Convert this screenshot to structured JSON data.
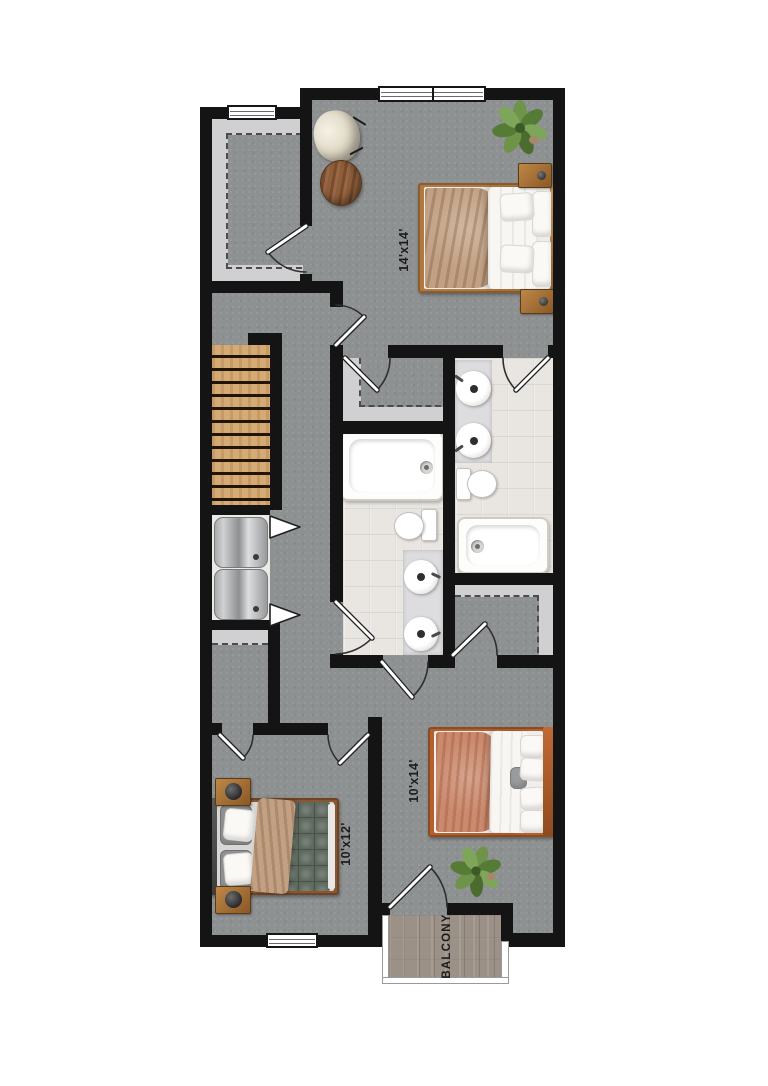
{
  "plan": {
    "rooms": {
      "master_bedroom": {
        "dimension_label": "14'x14'"
      },
      "bedroom_left": {
        "dimension_label": "10'x12'"
      },
      "bedroom_right": {
        "dimension_label": "10'x14'"
      },
      "balcony": {
        "label": "BALCONY"
      }
    }
  },
  "palette": {
    "wall": "#141414",
    "carpet": "#8e9192",
    "tile": "#e9e6e1",
    "shelf": "#d0d0d2",
    "stair_wood": "#d6aa74",
    "balcony_wood": "#9b9187",
    "fixture": "#fdfdfc",
    "vanity": "#dddcde",
    "bed_wood": "#b0793f",
    "bed_wood_orange": "#b4602e",
    "bed_wood_brown": "#8a5733",
    "blanket_tan": "#c2a083",
    "blanket_salmon": "#c98a6d",
    "quilt_green": "#5f6a5f",
    "plant_green": "#6a8f46",
    "label": "#1c1c1c"
  }
}
